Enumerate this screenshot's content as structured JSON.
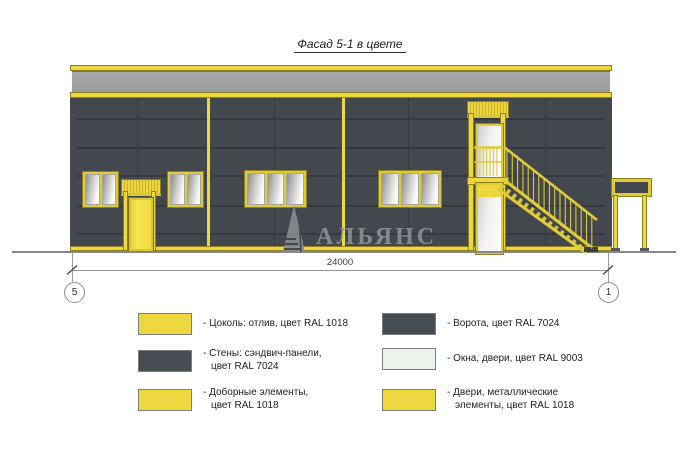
{
  "title": "Фасад 5-1 в цвете",
  "watermark": {
    "text": "АЛЬЯНС",
    "logo_icon": "sail-triangle-icon"
  },
  "dimension": {
    "label": "24000",
    "axis_left": "5",
    "axis_right": "1"
  },
  "legend": {
    "items": [
      {
        "swatch_color": "#EDD73E",
        "lines": [
          "- Цоколь: отлив, цвет RAL 1018"
        ]
      },
      {
        "swatch_color": "#474B52",
        "lines": [
          "- Стены: сэндвич-панели,",
          "цвет RAL 7024"
        ]
      },
      {
        "swatch_color": "#EDD73E",
        "lines": [
          "- Доборные элементы,",
          "цвет RAL 1018"
        ]
      },
      {
        "swatch_color": "#474B52",
        "lines": [
          "- Ворота, цвет RAL 7024"
        ]
      },
      {
        "swatch_color": "#EDF3EB",
        "lines": [
          "- Окна, двери, цвет RAL 9003"
        ]
      },
      {
        "swatch_color": "#EDD73E",
        "lines": [
          "- Двери, металлические",
          "элементы, цвет RAL 1018"
        ]
      }
    ]
  },
  "colors": {
    "facade_yellow": "#EDD73E",
    "wall_dark": "#43474E",
    "parapet_gray": "#9EA0A0",
    "window_light": "#EDF3EB",
    "drawing_line_gray": "#8A8C8E"
  }
}
